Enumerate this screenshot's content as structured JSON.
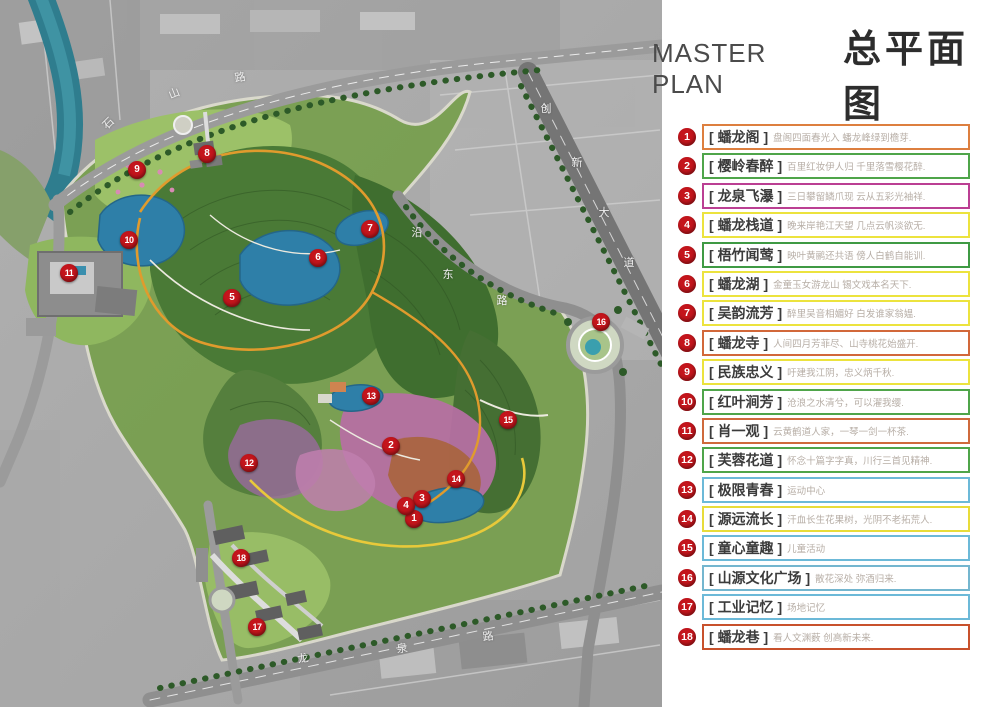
{
  "header": {
    "title_en": "MASTER PLAN",
    "title_zh": "总平面图"
  },
  "colors": {
    "marker_red": "#c4151c",
    "panel_bg": "#ffffff"
  },
  "legend": [
    {
      "num": "1",
      "name": "蟠龙阁",
      "desc": "盘阁四面春光入  蟠龙峰绿到檐芽.",
      "border": "#dd7f3f"
    },
    {
      "num": "2",
      "name": "樱岭春醉",
      "desc": "百里红妆伊人归  千里落雪樱花醉.",
      "border": "#4fa54a"
    },
    {
      "num": "3",
      "name": "龙泉飞瀑",
      "desc": "三日攀留鳞爪现  云从五彩光袖祥.",
      "border": "#bb3f93"
    },
    {
      "num": "4",
      "name": "蟠龙栈道",
      "desc": "晚来岸艳江天望  几点云帆淡欲无.",
      "border": "#ece33e"
    },
    {
      "num": "5",
      "name": "梧竹闻莺",
      "desc": "映叶黄鹂还共语  傍人白鹤自能训.",
      "border": "#3f9a44"
    },
    {
      "num": "6",
      "name": "蟠龙湖",
      "desc": "金童玉女游龙山  锡文戏本名天下.",
      "border": "#ece33e"
    },
    {
      "num": "7",
      "name": "吴韵流芳",
      "desc": "醉里吴音相媚好  白发谁家翁媪.",
      "border": "#ece33e"
    },
    {
      "num": "8",
      "name": "蟠龙寺",
      "desc": "人间四月芳菲尽、山寺桃花始盛开.",
      "border": "#d2683a"
    },
    {
      "num": "9",
      "name": "民族忠义",
      "desc": "吁建我江阴，忠义炳千秋.",
      "border": "#ece33e"
    },
    {
      "num": "10",
      "name": "红叶涧芳",
      "desc": "沧浪之水清兮，可以濯我缨.",
      "border": "#4fa54a"
    },
    {
      "num": "11",
      "name": "肖一观",
      "desc": "云黄鹤道人家，一琴一剑一杯茶.",
      "border": "#cf6a3c"
    },
    {
      "num": "12",
      "name": "芙蓉花道",
      "desc": "怀念十篇字字真，川行三首见精神.",
      "border": "#4fa54a"
    },
    {
      "num": "13",
      "name": "极限青春",
      "desc": "运动中心",
      "border": "#6cb9d8"
    },
    {
      "num": "14",
      "name": "源远流长",
      "desc": "汗血长生花果树，光阴不老拓荒人.",
      "border": "#e8dc3a"
    },
    {
      "num": "15",
      "name": "童心童趣",
      "desc": "儿童活动",
      "border": "#6cb9d8"
    },
    {
      "num": "16",
      "name": "山源文化广场",
      "desc": "散花深处 弥酒归来.",
      "border": "#74b6cf"
    },
    {
      "num": "17",
      "name": "工业记忆",
      "desc": "场地记忆",
      "border": "#6cb9d8"
    },
    {
      "num": "18",
      "name": "蟠龙巷",
      "desc": "看人文渊薮  创高新未来.",
      "border": "#c8512c"
    }
  ],
  "map": {
    "markers": [
      {
        "num": "1",
        "x": 414,
        "y": 519
      },
      {
        "num": "2",
        "x": 391,
        "y": 446
      },
      {
        "num": "3",
        "x": 422,
        "y": 499
      },
      {
        "num": "4",
        "x": 406,
        "y": 506
      },
      {
        "num": "5",
        "x": 232,
        "y": 298
      },
      {
        "num": "6",
        "x": 318,
        "y": 258
      },
      {
        "num": "7",
        "x": 370,
        "y": 229
      },
      {
        "num": "8",
        "x": 207,
        "y": 154
      },
      {
        "num": "9",
        "x": 137,
        "y": 170
      },
      {
        "num": "10",
        "x": 129,
        "y": 240
      },
      {
        "num": "11",
        "x": 69,
        "y": 273
      },
      {
        "num": "12",
        "x": 249,
        "y": 463
      },
      {
        "num": "13",
        "x": 371,
        "y": 396
      },
      {
        "num": "14",
        "x": 456,
        "y": 479
      },
      {
        "num": "15",
        "x": 508,
        "y": 420
      },
      {
        "num": "16",
        "x": 601,
        "y": 322
      },
      {
        "num": "17",
        "x": 257,
        "y": 627
      },
      {
        "num": "18",
        "x": 241,
        "y": 558
      }
    ],
    "road_labels": [
      {
        "text": "石",
        "x": 108,
        "y": 123,
        "rot": -45
      },
      {
        "text": "山",
        "x": 174,
        "y": 93,
        "rot": -22
      },
      {
        "text": "路",
        "x": 240,
        "y": 77,
        "rot": -10
      },
      {
        "text": "创",
        "x": 546,
        "y": 108,
        "rot": 0
      },
      {
        "text": "新",
        "x": 577,
        "y": 162,
        "rot": 0
      },
      {
        "text": "大",
        "x": 604,
        "y": 212,
        "rot": 0
      },
      {
        "text": "道",
        "x": 629,
        "y": 262,
        "rot": 0
      },
      {
        "text": "沿",
        "x": 417,
        "y": 232,
        "rot": 0
      },
      {
        "text": "东",
        "x": 448,
        "y": 274,
        "rot": 0
      },
      {
        "text": "路",
        "x": 502,
        "y": 300,
        "rot": 0
      },
      {
        "text": "龙",
        "x": 303,
        "y": 658,
        "rot": -8
      },
      {
        "text": "泉",
        "x": 402,
        "y": 648,
        "rot": -8
      },
      {
        "text": "路",
        "x": 488,
        "y": 636,
        "rot": -8
      }
    ]
  }
}
